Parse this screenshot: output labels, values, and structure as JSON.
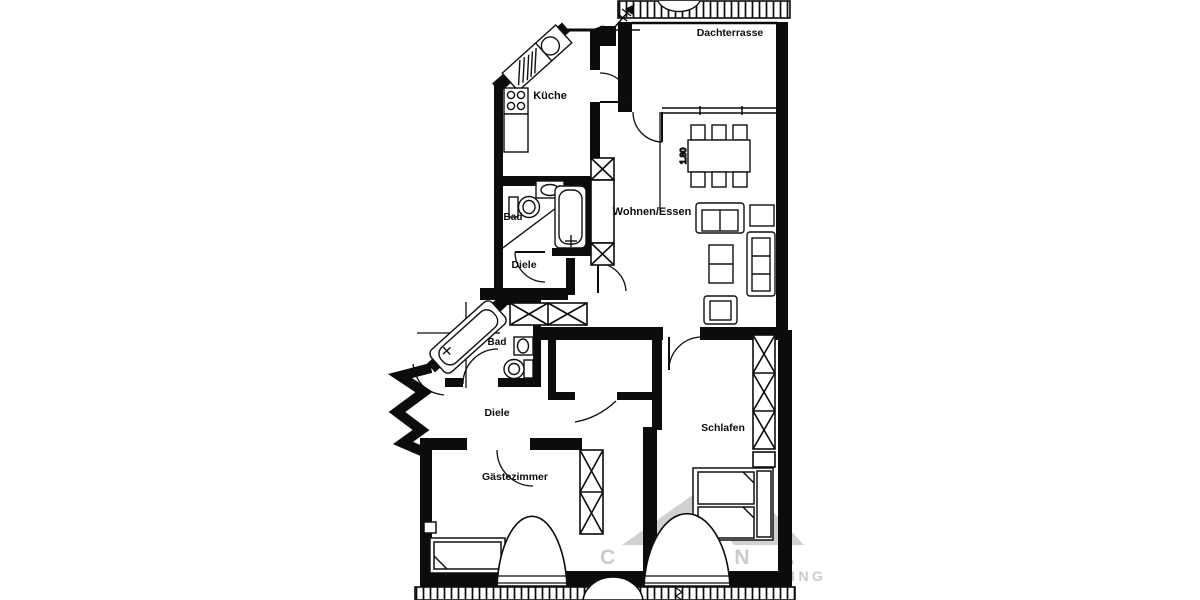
{
  "floor_plan": {
    "rooms": {
      "dachterrasse": {
        "label": "Dachterrasse"
      },
      "kueche": {
        "label": "Küche"
      },
      "wohnen_essen": {
        "label": "Wohnen/Essen"
      },
      "bad_upper": {
        "label": "Bad"
      },
      "diele_upper": {
        "label": "Diele"
      },
      "bad_lower": {
        "label": "Bad"
      },
      "diele_lower": {
        "label": "Diele"
      },
      "schlafen": {
        "label": "Schlafen"
      },
      "gaestezimmer": {
        "label": "Gästezimmer"
      }
    },
    "dimensions": {
      "dining_table": "1.80"
    },
    "fixture_icons": [
      "kitchen-sink-icon",
      "stove-icon",
      "bathtub-icon",
      "toilet-icon",
      "washbasin-icon",
      "double-bed-icon",
      "single-bed-icon",
      "wardrobe-icon",
      "shaft-icon",
      "sofa-icon",
      "dining-table-icon",
      "chair-icon",
      "coffee-table-icon",
      "armchair-icon",
      "door-swing-icon",
      "railing-icon",
      "dormer-window-icon",
      "north-arrow-icon"
    ],
    "colors": {
      "wall": "#0c0c0c",
      "background": "#ffffff",
      "watermark": "#c4c4c4"
    }
  },
  "watermark": {
    "line1": "COLNA",
    "line2": "IMMOBILIEN CONSULTING"
  }
}
